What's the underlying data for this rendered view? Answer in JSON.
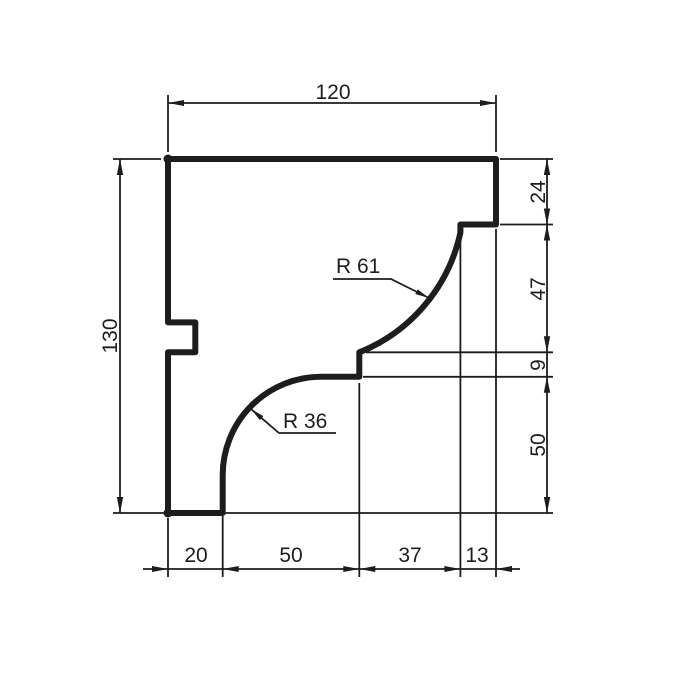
{
  "drawing": {
    "colors": {
      "line": "#1d1d1b",
      "background": "#ffffff"
    },
    "dims": {
      "top": "120",
      "left": "130",
      "right": [
        "24",
        "47",
        "9",
        "50"
      ],
      "bottom": [
        "20",
        "50",
        "37",
        "13"
      ]
    },
    "radii": [
      "R 61",
      "R 36"
    ]
  }
}
